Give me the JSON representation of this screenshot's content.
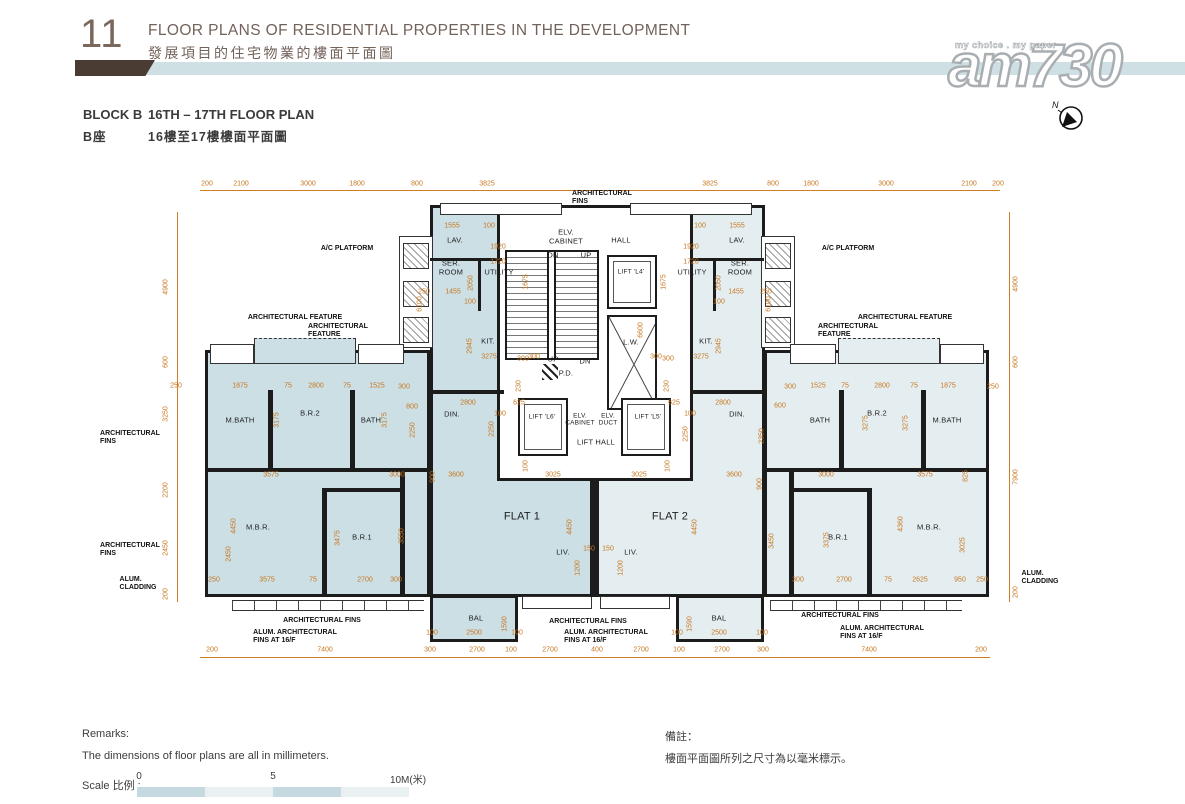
{
  "header": {
    "number": "11",
    "title_en": "FLOOR PLANS OF RESIDENTIAL PROPERTIES IN THE DEVELOPMENT",
    "title_zh": "發展項目的住宅物業的樓面平面圖",
    "block_en": "BLOCK B",
    "block_zh": "B座",
    "plan_en": "16TH – 17TH FLOOR PLAN",
    "plan_zh": "16樓至17樓樓面平面圖"
  },
  "watermark": {
    "tagline": "my choice . my paper",
    "logo": "am730",
    "compass_label": "N"
  },
  "remarks": {
    "en_title": "Remarks:",
    "en_body": "The dimensions of floor plans are all in millimeters.",
    "zh_title": "備註：",
    "zh_body": "樓面平面圖所列之尺寸為以毫米標示。"
  },
  "scale": {
    "label": "Scale 比例 :",
    "ticks": [
      "0",
      "5",
      "10M(米)"
    ]
  },
  "colors": {
    "dim_orange": "#c8761f",
    "flat1_fill": "#cbdfe4",
    "flat2_fill": "#e4eef1",
    "wall": "#1c1c1c",
    "header_bar": "#cfe0e4",
    "header_flag": "#4a3b33",
    "title_brown": "#73625a"
  },
  "plan": {
    "rooms": [
      {
        "t": "FLAT 1",
        "x": 522,
        "y": 517,
        "fs": 11
      },
      {
        "t": "FLAT 2",
        "x": 670,
        "y": 517,
        "fs": 11
      },
      {
        "t": "M.BATH",
        "x": 240,
        "y": 421
      },
      {
        "t": "B.R.2",
        "x": 310,
        "y": 414
      },
      {
        "t": "BATH",
        "x": 371,
        "y": 421
      },
      {
        "t": "M.B.R.",
        "x": 258,
        "y": 528
      },
      {
        "t": "B.R.1",
        "x": 362,
        "y": 538
      },
      {
        "t": "DIN.",
        "x": 452,
        "y": 415
      },
      {
        "t": "LIV.",
        "x": 563,
        "y": 553
      },
      {
        "t": "BAL",
        "x": 476,
        "y": 619
      },
      {
        "t": "LAV.",
        "x": 455,
        "y": 241
      },
      {
        "t": "SER.\nROOM",
        "x": 451,
        "y": 268
      },
      {
        "t": "UTILITY",
        "x": 499,
        "y": 273
      },
      {
        "t": "KIT.",
        "x": 488,
        "y": 342
      },
      {
        "t": "BATH",
        "x": 820,
        "y": 421
      },
      {
        "t": "B.R.2",
        "x": 877,
        "y": 414
      },
      {
        "t": "M.BATH",
        "x": 947,
        "y": 421
      },
      {
        "t": "B.R.1",
        "x": 838,
        "y": 538
      },
      {
        "t": "M.B.R.",
        "x": 929,
        "y": 528
      },
      {
        "t": "DIN.",
        "x": 737,
        "y": 415
      },
      {
        "t": "LIV.",
        "x": 631,
        "y": 553
      },
      {
        "t": "BAL",
        "x": 719,
        "y": 619
      },
      {
        "t": "LAV.",
        "x": 737,
        "y": 241
      },
      {
        "t": "SER.\nROOM",
        "x": 740,
        "y": 268
      },
      {
        "t": "UTILITY",
        "x": 692,
        "y": 273
      },
      {
        "t": "KIT.",
        "x": 706,
        "y": 342
      },
      {
        "t": "ELV.\nCABINET",
        "x": 566,
        "y": 237
      },
      {
        "t": "HALL",
        "x": 621,
        "y": 241
      },
      {
        "t": "DN",
        "x": 553,
        "y": 256
      },
      {
        "t": "UP",
        "x": 586,
        "y": 256
      },
      {
        "t": "LIFT 'L4'",
        "x": 631,
        "y": 272,
        "fs": 6.5
      },
      {
        "t": "L.W.",
        "x": 631,
        "y": 343
      },
      {
        "t": "UP",
        "x": 553,
        "y": 360
      },
      {
        "t": "DN",
        "x": 585,
        "y": 362
      },
      {
        "t": "P.D.",
        "x": 566,
        "y": 374
      },
      {
        "t": "LIFT 'L6'",
        "x": 542,
        "y": 417,
        "fs": 6.5
      },
      {
        "t": "ELV.\nCABINET",
        "x": 580,
        "y": 420,
        "fs": 6.5
      },
      {
        "t": "ELV.\nDUCT",
        "x": 608,
        "y": 420,
        "fs": 6.5
      },
      {
        "t": "LIFT 'L5'",
        "x": 648,
        "y": 417,
        "fs": 6.5
      },
      {
        "t": "LIFT HALL",
        "x": 596,
        "y": 443
      }
    ],
    "annotations": [
      {
        "t": "A/C PLATFORM",
        "x": 347,
        "y": 249
      },
      {
        "t": "ARCHITECTURAL FEATURE",
        "x": 295,
        "y": 318
      },
      {
        "t": "ARCHITECTURAL\nFEATURE",
        "x": 338,
        "y": 331
      },
      {
        "t": "ARCHITECTURAL\nFINS",
        "x": 130,
        "y": 438
      },
      {
        "t": "ARCHITECTURAL\nFINS",
        "x": 130,
        "y": 550
      },
      {
        "t": "ALUM.\nCLADDING",
        "x": 138,
        "y": 584
      },
      {
        "t": "ARCHITECTURAL FINS",
        "x": 322,
        "y": 621
      },
      {
        "t": "ALUM. ARCHITECTURAL\nFINS AT 16/F",
        "x": 295,
        "y": 637
      },
      {
        "t": "ARCHITECTURAL\nFINS",
        "x": 602,
        "y": 198
      },
      {
        "t": "ARCHITECTURAL FINS",
        "x": 588,
        "y": 622
      },
      {
        "t": "ALUM. ARCHITECTURAL\nFINS AT 16/F",
        "x": 606,
        "y": 637
      },
      {
        "t": "A/C PLATFORM",
        "x": 848,
        "y": 249
      },
      {
        "t": "ARCHITECTURAL FEATURE",
        "x": 905,
        "y": 318
      },
      {
        "t": "ARCHITECTURAL\nFEATURE",
        "x": 848,
        "y": 331
      },
      {
        "t": "ALUM.\nCLADDING",
        "x": 1040,
        "y": 578
      },
      {
        "t": "ARCHITECTURAL FINS",
        "x": 840,
        "y": 616
      },
      {
        "t": "ALUM. ARCHITECTURAL\nFINS AT 16/F",
        "x": 882,
        "y": 633
      }
    ],
    "dims": [
      {
        "t": "200",
        "x": 207,
        "y": 184
      },
      {
        "t": "2100",
        "x": 241,
        "y": 184
      },
      {
        "t": "3000",
        "x": 308,
        "y": 184
      },
      {
        "t": "1800",
        "x": 357,
        "y": 184
      },
      {
        "t": "800",
        "x": 417,
        "y": 184
      },
      {
        "t": "3825",
        "x": 487,
        "y": 184
      },
      {
        "t": "3825",
        "x": 710,
        "y": 184
      },
      {
        "t": "800",
        "x": 773,
        "y": 184
      },
      {
        "t": "1800",
        "x": 811,
        "y": 184
      },
      {
        "t": "3000",
        "x": 886,
        "y": 184
      },
      {
        "t": "2100",
        "x": 969,
        "y": 184
      },
      {
        "t": "200",
        "x": 998,
        "y": 184
      },
      {
        "t": "200",
        "x": 212,
        "y": 650
      },
      {
        "t": "7400",
        "x": 325,
        "y": 650
      },
      {
        "t": "300",
        "x": 430,
        "y": 650
      },
      {
        "t": "2700",
        "x": 477,
        "y": 650
      },
      {
        "t": "100",
        "x": 511,
        "y": 650
      },
      {
        "t": "2700",
        "x": 550,
        "y": 650
      },
      {
        "t": "400",
        "x": 597,
        "y": 650
      },
      {
        "t": "2700",
        "x": 641,
        "y": 650
      },
      {
        "t": "100",
        "x": 679,
        "y": 650
      },
      {
        "t": "2700",
        "x": 722,
        "y": 650
      },
      {
        "t": "300",
        "x": 763,
        "y": 650
      },
      {
        "t": "7400",
        "x": 869,
        "y": 650
      },
      {
        "t": "200",
        "x": 981,
        "y": 650
      },
      {
        "t": "4900",
        "x": 166,
        "y": 287,
        "v": 1
      },
      {
        "t": "600",
        "x": 166,
        "y": 362,
        "v": 1
      },
      {
        "t": "3250",
        "x": 166,
        "y": 414,
        "v": 1
      },
      {
        "t": "2200",
        "x": 166,
        "y": 490,
        "v": 1
      },
      {
        "t": "2450",
        "x": 166,
        "y": 548,
        "v": 1
      },
      {
        "t": "200",
        "x": 166,
        "y": 594,
        "v": 1
      },
      {
        "t": "4900",
        "x": 1016,
        "y": 284,
        "v": 1
      },
      {
        "t": "600",
        "x": 1016,
        "y": 362,
        "v": 1
      },
      {
        "t": "7900",
        "x": 1016,
        "y": 477,
        "v": 1
      },
      {
        "t": "200",
        "x": 1016,
        "y": 592,
        "v": 1
      },
      {
        "t": "1555",
        "x": 452,
        "y": 226
      },
      {
        "t": "100",
        "x": 489,
        "y": 226
      },
      {
        "t": "1920",
        "x": 498,
        "y": 247
      },
      {
        "t": "1720",
        "x": 498,
        "y": 262
      },
      {
        "t": "2050",
        "x": 471,
        "y": 283,
        "v": 1
      },
      {
        "t": "1675",
        "x": 526,
        "y": 282,
        "v": 1
      },
      {
        "t": "1455",
        "x": 453,
        "y": 292
      },
      {
        "t": "100",
        "x": 470,
        "y": 302
      },
      {
        "t": "250",
        "x": 424,
        "y": 292
      },
      {
        "t": "2945",
        "x": 470,
        "y": 346,
        "v": 1
      },
      {
        "t": "3275",
        "x": 489,
        "y": 357
      },
      {
        "t": "300",
        "x": 534,
        "y": 357
      },
      {
        "t": "6100",
        "x": 420,
        "y": 304,
        "v": 1
      },
      {
        "t": "1555",
        "x": 737,
        "y": 226
      },
      {
        "t": "100",
        "x": 700,
        "y": 226
      },
      {
        "t": "1920",
        "x": 691,
        "y": 247
      },
      {
        "t": "1720",
        "x": 691,
        "y": 262
      },
      {
        "t": "2050",
        "x": 719,
        "y": 283,
        "v": 1
      },
      {
        "t": "1675",
        "x": 664,
        "y": 282,
        "v": 1
      },
      {
        "t": "1455",
        "x": 736,
        "y": 292
      },
      {
        "t": "100",
        "x": 719,
        "y": 302
      },
      {
        "t": "250",
        "x": 766,
        "y": 292
      },
      {
        "t": "2945",
        "x": 719,
        "y": 346,
        "v": 1
      },
      {
        "t": "3275",
        "x": 701,
        "y": 357
      },
      {
        "t": "300",
        "x": 656,
        "y": 357
      },
      {
        "t": "6100",
        "x": 769,
        "y": 304,
        "v": 1
      },
      {
        "t": "6600",
        "x": 641,
        "y": 330,
        "v": 1
      },
      {
        "t": "300",
        "x": 523,
        "y": 359
      },
      {
        "t": "300",
        "x": 668,
        "y": 359
      },
      {
        "t": "230",
        "x": 519,
        "y": 386,
        "v": 1
      },
      {
        "t": "230",
        "x": 667,
        "y": 386,
        "v": 1
      },
      {
        "t": "625",
        "x": 519,
        "y": 403
      },
      {
        "t": "625",
        "x": 674,
        "y": 403
      },
      {
        "t": "100",
        "x": 500,
        "y": 414
      },
      {
        "t": "100",
        "x": 690,
        "y": 414
      },
      {
        "t": "2250",
        "x": 686,
        "y": 434,
        "v": 1
      },
      {
        "t": "2250",
        "x": 492,
        "y": 429,
        "v": 1
      },
      {
        "t": "100",
        "x": 668,
        "y": 466,
        "v": 1
      },
      {
        "t": "100",
        "x": 526,
        "y": 466,
        "v": 1
      },
      {
        "t": "3025",
        "x": 553,
        "y": 475
      },
      {
        "t": "3025",
        "x": 639,
        "y": 475
      },
      {
        "t": "2800",
        "x": 468,
        "y": 403
      },
      {
        "t": "800",
        "x": 412,
        "y": 407
      },
      {
        "t": "2250",
        "x": 413,
        "y": 430,
        "v": 1
      },
      {
        "t": "900",
        "x": 433,
        "y": 477,
        "v": 1
      },
      {
        "t": "3600",
        "x": 456,
        "y": 475
      },
      {
        "t": "2800",
        "x": 723,
        "y": 403
      },
      {
        "t": "600",
        "x": 780,
        "y": 406
      },
      {
        "t": "2350",
        "x": 762,
        "y": 436,
        "v": 1
      },
      {
        "t": "900",
        "x": 760,
        "y": 484,
        "v": 1
      },
      {
        "t": "3600",
        "x": 734,
        "y": 475
      },
      {
        "t": "250",
        "x": 176,
        "y": 386
      },
      {
        "t": "1875",
        "x": 240,
        "y": 386
      },
      {
        "t": "75",
        "x": 288,
        "y": 386
      },
      {
        "t": "2800",
        "x": 316,
        "y": 386
      },
      {
        "t": "75",
        "x": 347,
        "y": 386
      },
      {
        "t": "1525",
        "x": 377,
        "y": 386
      },
      {
        "t": "300",
        "x": 404,
        "y": 387
      },
      {
        "t": "3175",
        "x": 277,
        "y": 420,
        "v": 1
      },
      {
        "t": "3175",
        "x": 385,
        "y": 420,
        "v": 1
      },
      {
        "t": "3575",
        "x": 271,
        "y": 475
      },
      {
        "t": "3000",
        "x": 397,
        "y": 475
      },
      {
        "t": "2450",
        "x": 229,
        "y": 554,
        "v": 1
      },
      {
        "t": "4450",
        "x": 234,
        "y": 526,
        "v": 1
      },
      {
        "t": "3475",
        "x": 338,
        "y": 538,
        "v": 1
      },
      {
        "t": "3550",
        "x": 402,
        "y": 536,
        "v": 1
      },
      {
        "t": "250",
        "x": 214,
        "y": 580
      },
      {
        "t": "3575",
        "x": 267,
        "y": 580
      },
      {
        "t": "75",
        "x": 313,
        "y": 580
      },
      {
        "t": "2700",
        "x": 365,
        "y": 580
      },
      {
        "t": "300",
        "x": 396,
        "y": 580
      },
      {
        "t": "300",
        "x": 790,
        "y": 387
      },
      {
        "t": "1525",
        "x": 818,
        "y": 386
      },
      {
        "t": "75",
        "x": 845,
        "y": 386
      },
      {
        "t": "2800",
        "x": 882,
        "y": 386
      },
      {
        "t": "75",
        "x": 914,
        "y": 386
      },
      {
        "t": "1875",
        "x": 948,
        "y": 386
      },
      {
        "t": "250",
        "x": 993,
        "y": 387
      },
      {
        "t": "3275",
        "x": 866,
        "y": 423,
        "v": 1
      },
      {
        "t": "3275",
        "x": 906,
        "y": 423,
        "v": 1
      },
      {
        "t": "3000",
        "x": 826,
        "y": 475
      },
      {
        "t": "3575",
        "x": 925,
        "y": 475
      },
      {
        "t": "825",
        "x": 966,
        "y": 476,
        "v": 1
      },
      {
        "t": "3450",
        "x": 772,
        "y": 541,
        "v": 1
      },
      {
        "t": "3375",
        "x": 827,
        "y": 540,
        "v": 1
      },
      {
        "t": "4360",
        "x": 901,
        "y": 524,
        "v": 1
      },
      {
        "t": "3025",
        "x": 963,
        "y": 545,
        "v": 1
      },
      {
        "t": "300",
        "x": 798,
        "y": 580
      },
      {
        "t": "2700",
        "x": 844,
        "y": 580
      },
      {
        "t": "75",
        "x": 888,
        "y": 580
      },
      {
        "t": "2625",
        "x": 920,
        "y": 580
      },
      {
        "t": "950",
        "x": 960,
        "y": 580
      },
      {
        "t": "250",
        "x": 982,
        "y": 580
      },
      {
        "t": "4450",
        "x": 570,
        "y": 527,
        "v": 1
      },
      {
        "t": "4450",
        "x": 695,
        "y": 527,
        "v": 1
      },
      {
        "t": "150",
        "x": 589,
        "y": 549
      },
      {
        "t": "150",
        "x": 608,
        "y": 549
      },
      {
        "t": "1200",
        "x": 578,
        "y": 568,
        "v": 1
      },
      {
        "t": "1200",
        "x": 621,
        "y": 568,
        "v": 1
      },
      {
        "t": "100",
        "x": 432,
        "y": 633
      },
      {
        "t": "2500",
        "x": 474,
        "y": 633
      },
      {
        "t": "100",
        "x": 517,
        "y": 633
      },
      {
        "t": "1590",
        "x": 505,
        "y": 624,
        "v": 1
      },
      {
        "t": "100",
        "x": 677,
        "y": 633
      },
      {
        "t": "2500",
        "x": 719,
        "y": 633
      },
      {
        "t": "100",
        "x": 762,
        "y": 633
      },
      {
        "t": "1590",
        "x": 690,
        "y": 624,
        "v": 1
      }
    ]
  }
}
